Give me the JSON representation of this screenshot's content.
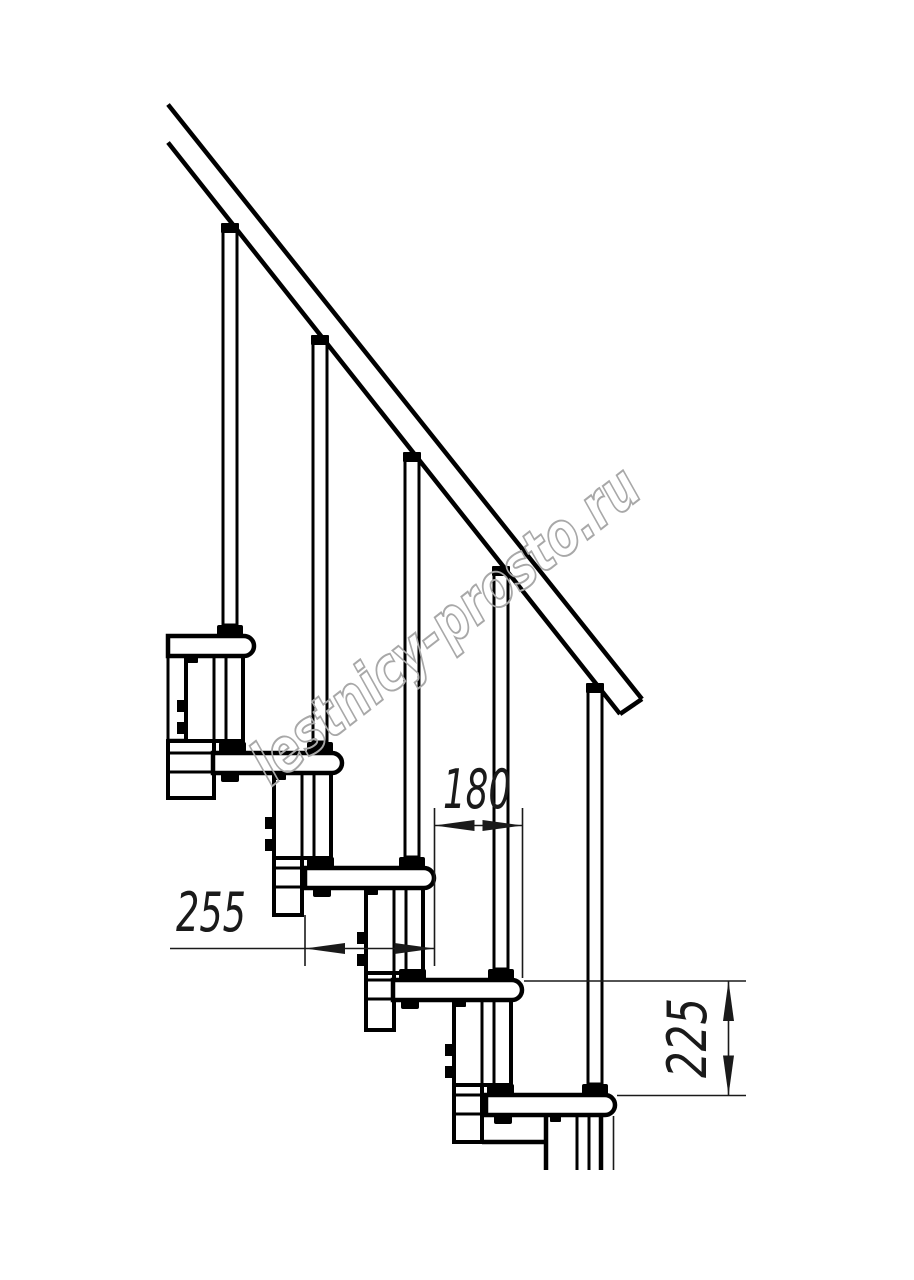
{
  "title": "Modular staircase side-view technical drawing",
  "watermark": {
    "text": "lestnicy-prosto.ru",
    "color": "#a8a8a8"
  },
  "drawing": {
    "background": "#ffffff",
    "line_color": "#000000",
    "dimension_color": "#1a1a1a",
    "steps_visible": 5,
    "dimensions": [
      {
        "id": "d180",
        "label": "180",
        "orientation": "horizontal"
      },
      {
        "id": "d255",
        "label": "255",
        "orientation": "horizontal"
      },
      {
        "id": "d225",
        "label": "225",
        "orientation": "vertical"
      }
    ]
  }
}
